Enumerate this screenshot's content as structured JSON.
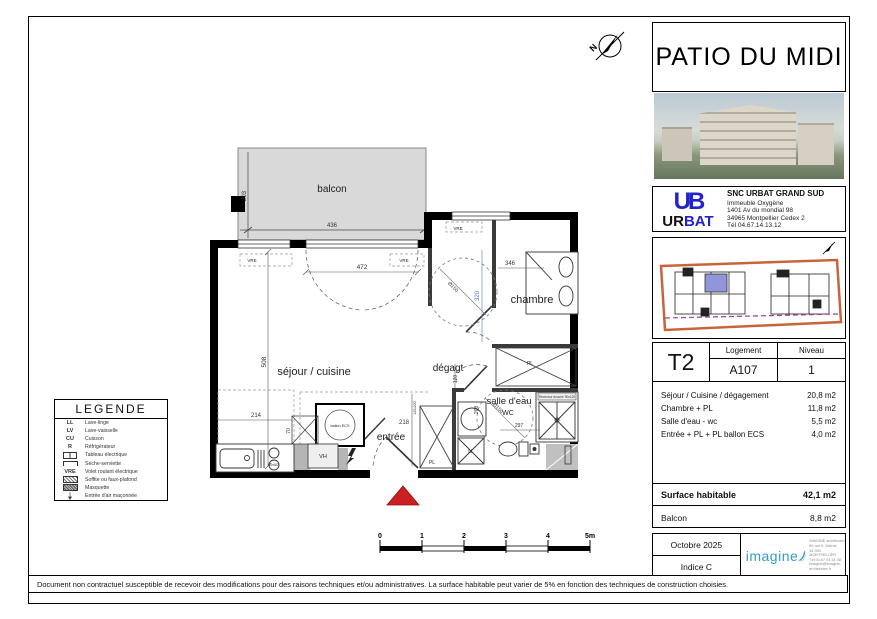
{
  "project": {
    "title": "PATIO DU MIDI"
  },
  "developer": {
    "logo_mark": "UB",
    "logo_ur": "UR",
    "logo_bat": "BAT",
    "name": "SNC URBAT GRAND SUD",
    "address_lines": [
      "Immeuble Oxygène",
      "1401 Av du mondial 98",
      "34965 Montpellier Cedex 2",
      "Tél 04.67.14.13.12"
    ]
  },
  "unit": {
    "type": "T2",
    "logement_label": "Logement",
    "logement_value": "A107",
    "niveau_label": "Niveau",
    "niveau_value": "1"
  },
  "areas": [
    {
      "label": "Séjour / Cuisine /  dégagement",
      "value": "20,8 m2"
    },
    {
      "label": "Chambre  + PL",
      "value": "11,8 m2"
    },
    {
      "label": "Salle d'eau - wc",
      "value": "5,5 m2"
    },
    {
      "label": "Entrée + PL + PL ballon ECS",
      "value": "4,0 m2"
    }
  ],
  "totals": {
    "surface_label": "Surface habitable",
    "surface_value": "42,1 m2",
    "balcony_label": "Balcon",
    "balcony_value": "8,8 m2"
  },
  "revision": {
    "date": "Octobre 2025",
    "indice": "Indice C"
  },
  "architect": {
    "logo": "imagine",
    "lines": [
      "IMAGINE architectes",
      "89 rue A. Michel",
      "34 000 MONTPELLIER",
      "Tél 04 67 04 51 08",
      "imagine@imagine-architectes.fr"
    ]
  },
  "legend": {
    "title": "LEGENDE",
    "items": [
      {
        "symbol": "LL",
        "label": "Lave-linge"
      },
      {
        "symbol": "LV",
        "label": "Lave-vaisselle"
      },
      {
        "symbol": "CU",
        "label": "Cuisson"
      },
      {
        "symbol": "R",
        "label": "Réfrigérateur"
      },
      {
        "symbol": "",
        "label": "Tableau électrique"
      },
      {
        "symbol": "",
        "label": "Sèche-serviette"
      },
      {
        "symbol": "VRE",
        "label": "Volet roulant électrique"
      },
      {
        "symbol": "",
        "label": "Soffite ou faux-plafond"
      },
      {
        "symbol": "",
        "label": "Masquette"
      },
      {
        "symbol": "",
        "label": "Entrée d'air maçonnée"
      }
    ]
  },
  "plan": {
    "north_label": "N",
    "rooms": {
      "balcon": "balcon",
      "chambre": "chambre",
      "sejour": "séjour / cuisine",
      "degagement": "dégagt",
      "salle_eau": "salle d'eau",
      "wc": "WC",
      "entree": "entrée",
      "pl": "PL",
      "ll": "LL",
      "vh": "VH",
      "ballon": "ballon ECS",
      "vre": "VRE"
    },
    "dims": {
      "d203": "203",
      "d436": "436",
      "d472": "472",
      "d508": "508",
      "d214": "214",
      "d346": "346",
      "d320": "320",
      "d218": "218",
      "d120": "120",
      "d268": "268",
      "d297": "297",
      "d150": "Ø150",
      "d60": "60x60",
      "d70": "70",
      "shower": "Receveur douche 90x120",
      "menuiserie": "120x220"
    }
  },
  "scalebar": {
    "labels": [
      "0",
      "1",
      "2",
      "3",
      "4",
      "5m"
    ]
  },
  "disclaimer": "Document non contractuel susceptible de recevoir des modifications pour des raisons techniques et/ou administratives. La surface habitable peut varier de 5% en fonction des techniques de construction choisies.",
  "colors": {
    "accent_blue": "#2323cc",
    "imagine_blue": "#3a9bc7",
    "site_orange": "#c8643c",
    "site_purple": "#9a3f9a",
    "unit_blue": "#9096d8",
    "triangle_red": "#cc2020",
    "balcony_gray": "#d9d9d9",
    "dim_blue": "#5b79c8"
  }
}
